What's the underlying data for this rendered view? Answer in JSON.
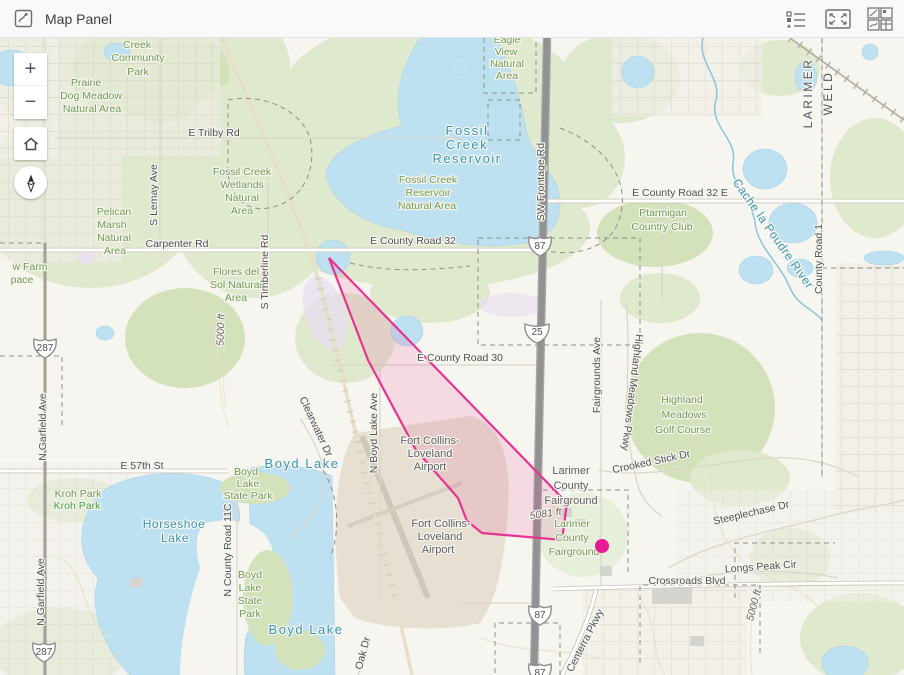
{
  "header": {
    "title": "Map Panel",
    "icons": {
      "panel": "map-panel-icon",
      "legend": "legend-icon",
      "expand": "expand-icon",
      "widgets": "widget-grid-icon"
    }
  },
  "controls": {
    "zoom_in": "+",
    "zoom_out": "−",
    "home": "home",
    "compass": "north"
  },
  "map": {
    "overlay": {
      "polygon": {
        "points": [
          [
            329,
            220
          ],
          [
            567,
            465
          ],
          [
            562,
            502
          ],
          [
            482,
            495
          ],
          [
            467,
            483
          ],
          [
            458,
            460
          ],
          [
            416,
            412
          ],
          [
            368,
            322
          ]
        ],
        "stroke": "#e73493",
        "fill": "rgba(231,60,150,0.14)"
      },
      "marker": {
        "x": 602,
        "y": 508,
        "r": 7,
        "color": "#e81c94"
      }
    },
    "shields": [
      {
        "type": "us",
        "label": "87",
        "x": 540,
        "y": 207
      },
      {
        "type": "interstate",
        "label": "25",
        "x": 537,
        "y": 293
      },
      {
        "type": "us",
        "label": "87",
        "x": 540,
        "y": 576
      },
      {
        "type": "us",
        "label": "87",
        "x": 540,
        "y": 634
      },
      {
        "type": "us",
        "label": "287",
        "x": 45,
        "y": 309
      },
      {
        "type": "us",
        "label": "287",
        "x": 44,
        "y": 613
      }
    ],
    "labels": [
      {
        "t": "Creek",
        "x": 137,
        "y": 10,
        "c": "g"
      },
      {
        "t": "Community",
        "x": 138,
        "y": 23,
        "c": "g"
      },
      {
        "t": "Park",
        "x": 138,
        "y": 37,
        "c": "g"
      },
      {
        "t": "Prairie",
        "x": 86,
        "y": 48,
        "c": "g"
      },
      {
        "t": "Dog Meadow",
        "x": 91,
        "y": 61,
        "c": "g"
      },
      {
        "t": "Natural Area",
        "x": 92,
        "y": 74,
        "c": "g"
      },
      {
        "t": "Eagle",
        "x": 507,
        "y": 5,
        "c": "g"
      },
      {
        "t": "View",
        "x": 506,
        "y": 17,
        "c": "g"
      },
      {
        "t": "Natural",
        "x": 507,
        "y": 29,
        "c": "g"
      },
      {
        "t": "Area",
        "x": 507,
        "y": 41,
        "c": "g"
      },
      {
        "t": "E Trilby Rd",
        "x": 214,
        "y": 98,
        "c": "r"
      },
      {
        "t": "Fossil Creek",
        "x": 242,
        "y": 137,
        "c": "g"
      },
      {
        "t": "Wetlands",
        "x": 242,
        "y": 150,
        "c": "g"
      },
      {
        "t": "Natural",
        "x": 242,
        "y": 163,
        "c": "g"
      },
      {
        "t": "Area",
        "x": 242,
        "y": 176,
        "c": "g"
      },
      {
        "t": "Fossil",
        "x": 467,
        "y": 97,
        "c": "wl"
      },
      {
        "t": "Creek",
        "x": 467,
        "y": 111,
        "c": "wl"
      },
      {
        "t": "Reservoir",
        "x": 467,
        "y": 125,
        "c": "wl"
      },
      {
        "t": "Fossil Creek",
        "x": 428,
        "y": 145,
        "c": "g"
      },
      {
        "t": "Reservoir",
        "x": 428,
        "y": 158,
        "c": "g"
      },
      {
        "t": "Natural Area",
        "x": 427,
        "y": 171,
        "c": "g"
      },
      {
        "t": "Pelican",
        "x": 114,
        "y": 177,
        "c": "g"
      },
      {
        "t": "Marsh",
        "x": 112,
        "y": 190,
        "c": "g"
      },
      {
        "t": "Natural",
        "x": 114,
        "y": 203,
        "c": "g"
      },
      {
        "t": "Area",
        "x": 115,
        "y": 216,
        "c": "g"
      },
      {
        "t": "Carpenter Rd",
        "x": 177,
        "y": 209,
        "c": "r"
      },
      {
        "t": "E County Road 32",
        "x": 413,
        "y": 206,
        "c": "r"
      },
      {
        "t": "E County Road 32 E",
        "x": 680,
        "y": 158,
        "c": "r"
      },
      {
        "t": "Ptarmigan",
        "x": 663,
        "y": 178,
        "c": "g"
      },
      {
        "t": "Country Club",
        "x": 662,
        "y": 192,
        "c": "g"
      },
      {
        "t": "Cache la Poudre River",
        "x": 770,
        "y": 198,
        "c": "w",
        "r": 55
      },
      {
        "t": "County Road 1",
        "x": 822,
        "y": 221,
        "c": "r",
        "r": -90
      },
      {
        "t": "LARIMER",
        "x": 812,
        "y": 55,
        "c": "c",
        "r": -90
      },
      {
        "t": "WELD",
        "x": 832,
        "y": 55,
        "c": "c",
        "r": -90
      },
      {
        "t": "w Farm",
        "x": 30,
        "y": 232,
        "c": "g"
      },
      {
        "t": "pace",
        "x": 22,
        "y": 245,
        "c": "g"
      },
      {
        "t": "Flores del",
        "x": 236,
        "y": 237,
        "c": "g"
      },
      {
        "t": "Sol Natural",
        "x": 236,
        "y": 250,
        "c": "g"
      },
      {
        "t": "Area",
        "x": 236,
        "y": 263,
        "c": "g"
      },
      {
        "t": "S Lemay Ave",
        "x": 157,
        "y": 157,
        "c": "r",
        "r": -90
      },
      {
        "t": "S Timberline Rd",
        "x": 268,
        "y": 234,
        "c": "r",
        "r": -90
      },
      {
        "t": "SW Frontage Rd",
        "x": 544,
        "y": 144,
        "c": "r",
        "r": -90
      },
      {
        "t": "E County Road 30",
        "x": 460,
        "y": 323,
        "c": "r"
      },
      {
        "t": "Fairgrounds Ave",
        "x": 600,
        "y": 337,
        "c": "r",
        "r": -90
      },
      {
        "t": "Highland Meadows Pkwy",
        "x": 629,
        "y": 354,
        "c": "r",
        "r": 97
      },
      {
        "t": "Highland",
        "x": 682,
        "y": 365,
        "c": "g"
      },
      {
        "t": "Meadows",
        "x": 684,
        "y": 380,
        "c": "g"
      },
      {
        "t": "Golf Course",
        "x": 683,
        "y": 395,
        "c": "g"
      },
      {
        "t": "Crooked Stick Dr",
        "x": 652,
        "y": 427,
        "c": "r",
        "r": -12
      },
      {
        "t": "N Garfield Ave",
        "x": 46,
        "y": 389,
        "c": "r",
        "r": -90
      },
      {
        "t": "N Garfield Ave",
        "x": 44,
        "y": 554,
        "c": "r",
        "r": -90
      },
      {
        "t": "E 57th St",
        "x": 142,
        "y": 431,
        "c": "r"
      },
      {
        "t": "Kroh Park",
        "x": 78,
        "y": 459,
        "c": "g"
      },
      {
        "t": "Kroh Park",
        "x": 77,
        "y": 471,
        "c": "gb"
      },
      {
        "t": "Boyd",
        "x": 246,
        "y": 437,
        "c": "g"
      },
      {
        "t": "Lake",
        "x": 248,
        "y": 449,
        "c": "g"
      },
      {
        "t": "State Park",
        "x": 248,
        "y": 461,
        "c": "g"
      },
      {
        "t": "Boyd Lake",
        "x": 302,
        "y": 430,
        "c": "wl"
      },
      {
        "t": "Horseshoe",
        "x": 174,
        "y": 490,
        "c": "w"
      },
      {
        "t": "Lake",
        "x": 175,
        "y": 504,
        "c": "w"
      },
      {
        "t": "N County Road 11C",
        "x": 231,
        "y": 512,
        "c": "r",
        "r": -90
      },
      {
        "t": "N Boyd Lake Ave",
        "x": 377,
        "y": 395,
        "c": "r",
        "r": -90
      },
      {
        "t": "Clearwater Dr",
        "x": 313,
        "y": 390,
        "c": "r",
        "r": 65
      },
      {
        "t": "Fort Collins-",
        "x": 430,
        "y": 406,
        "c": "p"
      },
      {
        "t": "Loveland",
        "x": 430,
        "y": 419,
        "c": "p"
      },
      {
        "t": "Airport",
        "x": 430,
        "y": 432,
        "c": "p"
      },
      {
        "t": "Fort Collins-",
        "x": 441,
        "y": 489,
        "c": "p"
      },
      {
        "t": "Loveland",
        "x": 440,
        "y": 502,
        "c": "p"
      },
      {
        "t": "Airport",
        "x": 438,
        "y": 515,
        "c": "p"
      },
      {
        "t": "Larimer",
        "x": 571,
        "y": 436,
        "c": "p"
      },
      {
        "t": "County",
        "x": 571,
        "y": 451,
        "c": "p"
      },
      {
        "t": "Fairground",
        "x": 571,
        "y": 466,
        "c": "p"
      },
      {
        "t": "5081 ft",
        "x": 546,
        "y": 479,
        "c": "e",
        "r": -8
      },
      {
        "t": "Larimer",
        "x": 572,
        "y": 489,
        "c": "g"
      },
      {
        "t": "County",
        "x": 572,
        "y": 503,
        "c": "g"
      },
      {
        "t": "Fairground",
        "x": 574,
        "y": 517,
        "c": "g"
      },
      {
        "t": "Steeplechase Dr",
        "x": 752,
        "y": 478,
        "c": "r",
        "r": -13
      },
      {
        "t": "Longs Peak Cir",
        "x": 761,
        "y": 532,
        "c": "r",
        "r": -4
      },
      {
        "t": "Crossroads Blvd",
        "x": 687,
        "y": 546,
        "c": "r"
      },
      {
        "t": "5000 ft",
        "x": 757,
        "y": 568,
        "c": "e",
        "r": -75
      },
      {
        "t": "5000 ft",
        "x": 224,
        "y": 292,
        "c": "e",
        "r": -88
      },
      {
        "t": "Boyd",
        "x": 250,
        "y": 540,
        "c": "g"
      },
      {
        "t": "Lake",
        "x": 250,
        "y": 553,
        "c": "g"
      },
      {
        "t": "State",
        "x": 250,
        "y": 566,
        "c": "g"
      },
      {
        "t": "Park",
        "x": 250,
        "y": 579,
        "c": "g"
      },
      {
        "t": "Boyd Lake",
        "x": 306,
        "y": 596,
        "c": "wl"
      },
      {
        "t": "Centerra Pkwy",
        "x": 588,
        "y": 604,
        "c": "r",
        "r": -63
      },
      {
        "t": "Oak Dr",
        "x": 366,
        "y": 616,
        "c": "r",
        "r": -75
      }
    ]
  }
}
